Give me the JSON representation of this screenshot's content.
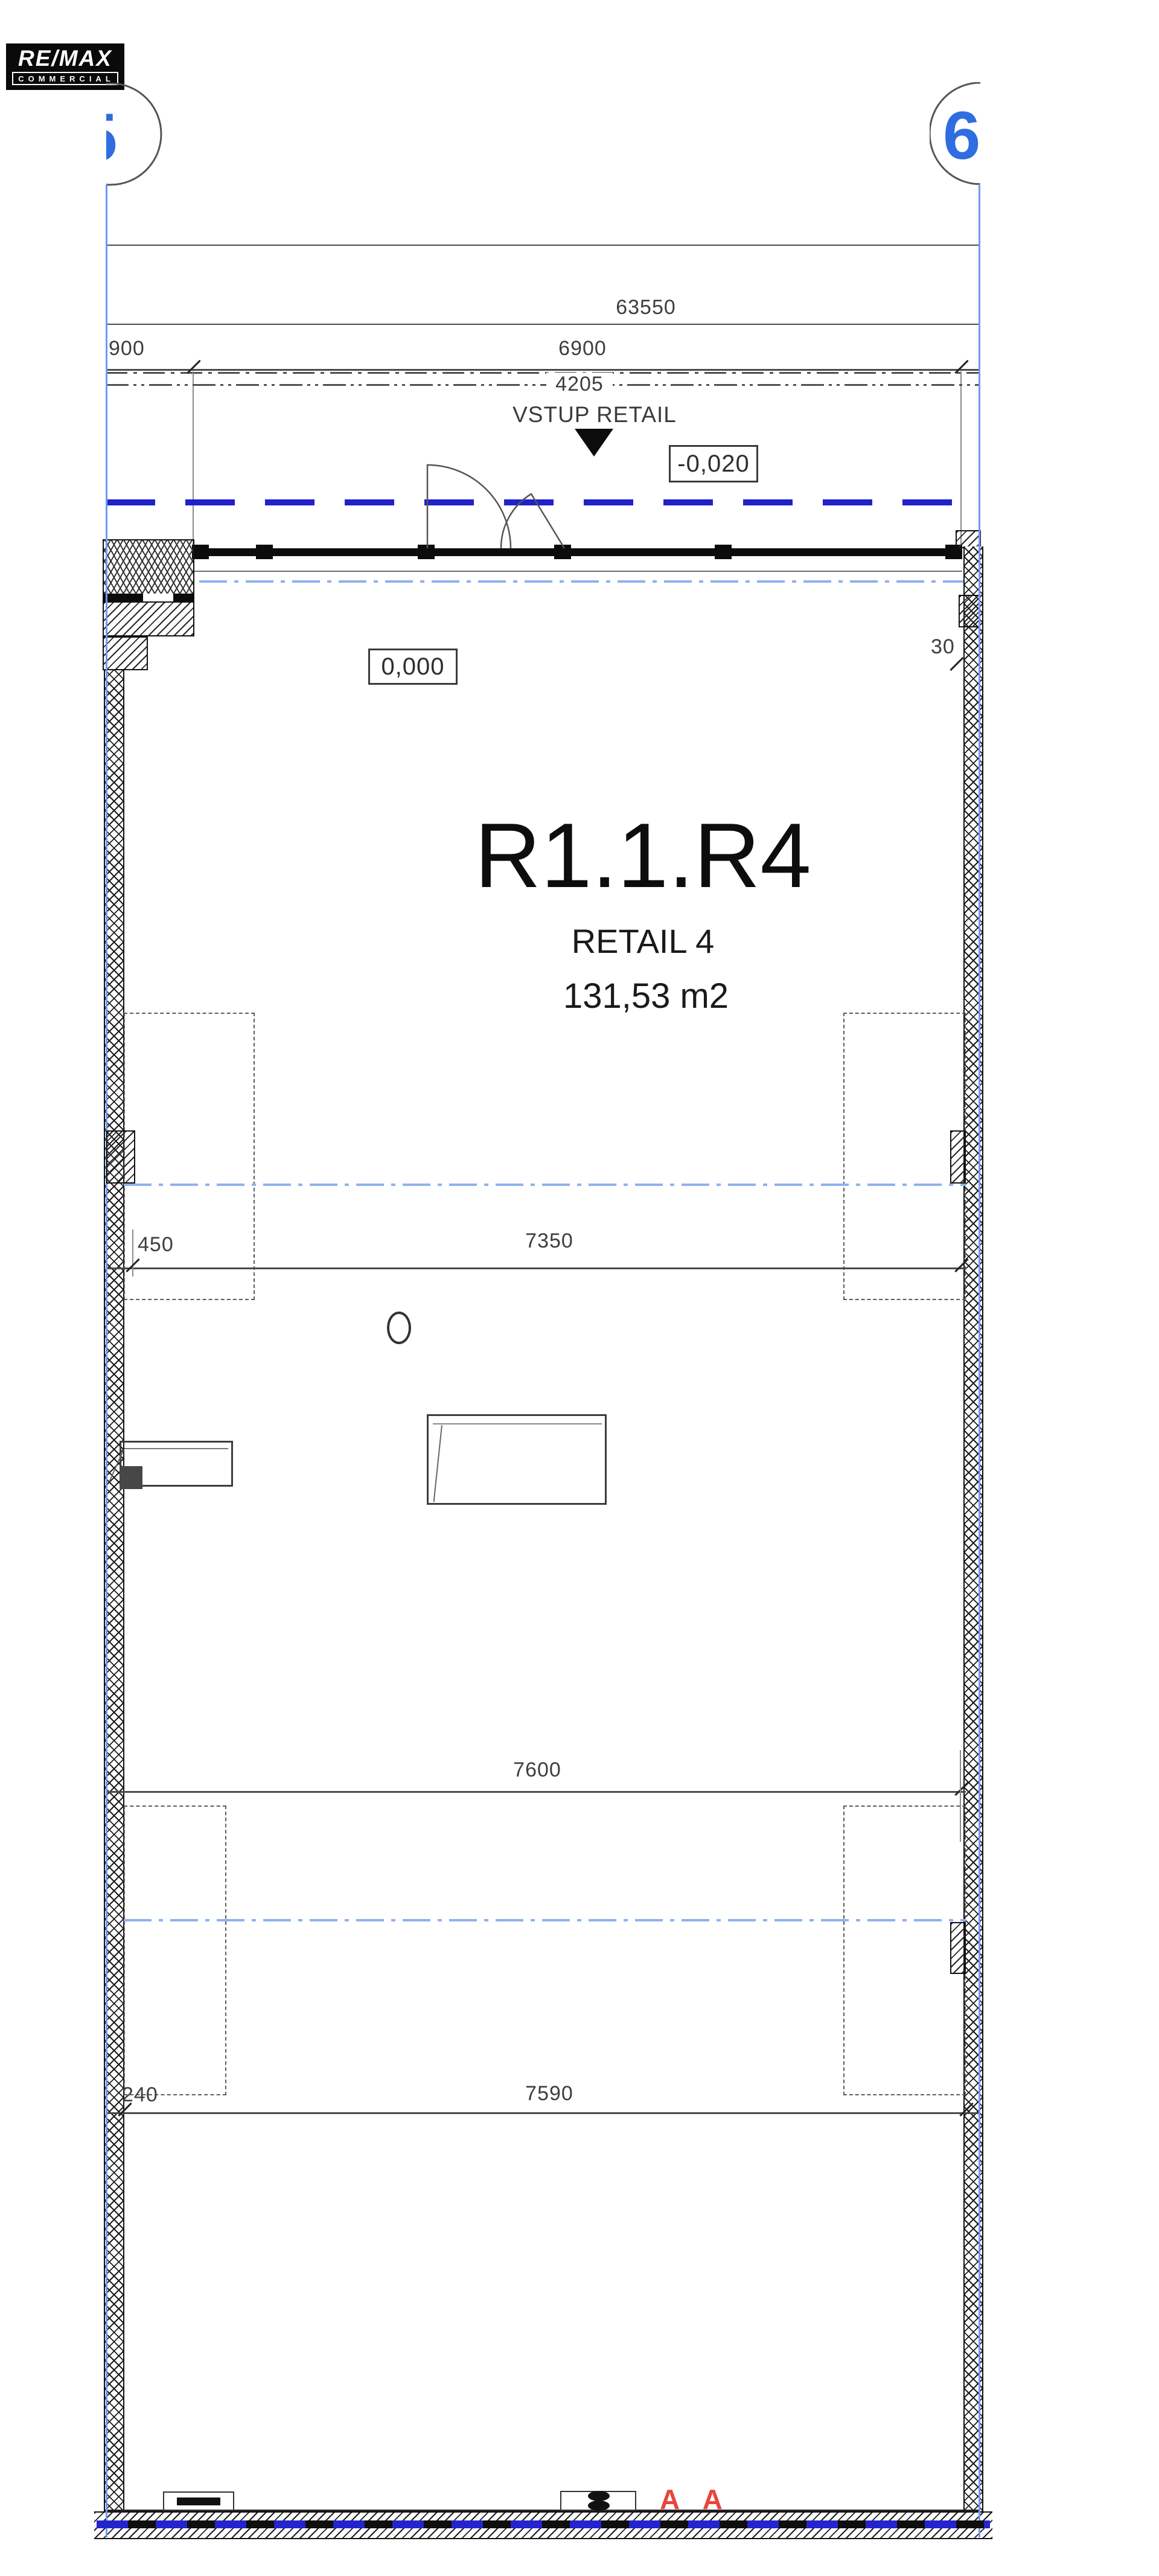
{
  "logo": {
    "line1": "RE/MAX",
    "line2": "COMMERCIAL"
  },
  "grid": {
    "left_label": "5",
    "right_label": "6"
  },
  "dimensions": {
    "overall": "63550",
    "d900": "900",
    "d6900": "6900",
    "d4205": "4205",
    "d450": "450",
    "d7350": "7350",
    "d7600": "7600",
    "d240": "240",
    "d7590": "7590",
    "d30": "30"
  },
  "levels": {
    "floor": "0,000",
    "entrance": "-0,020"
  },
  "labels": {
    "entrance": "VSTUP RETAIL",
    "unit_code": "R1.1.R4",
    "unit_name": "RETAIL 4",
    "unit_area": "131,53 m2",
    "section_marks": "A A"
  },
  "colors": {
    "grid_blue": "#2f6de0",
    "grid_line_blue": "#6e9cf0",
    "axis_light_blue": "#8fb2ee",
    "boundary_blue": "#2121cc",
    "section_red": "#e8453c",
    "line_gray": "#4a4a4a",
    "text_dark": "#1a1a1a"
  }
}
